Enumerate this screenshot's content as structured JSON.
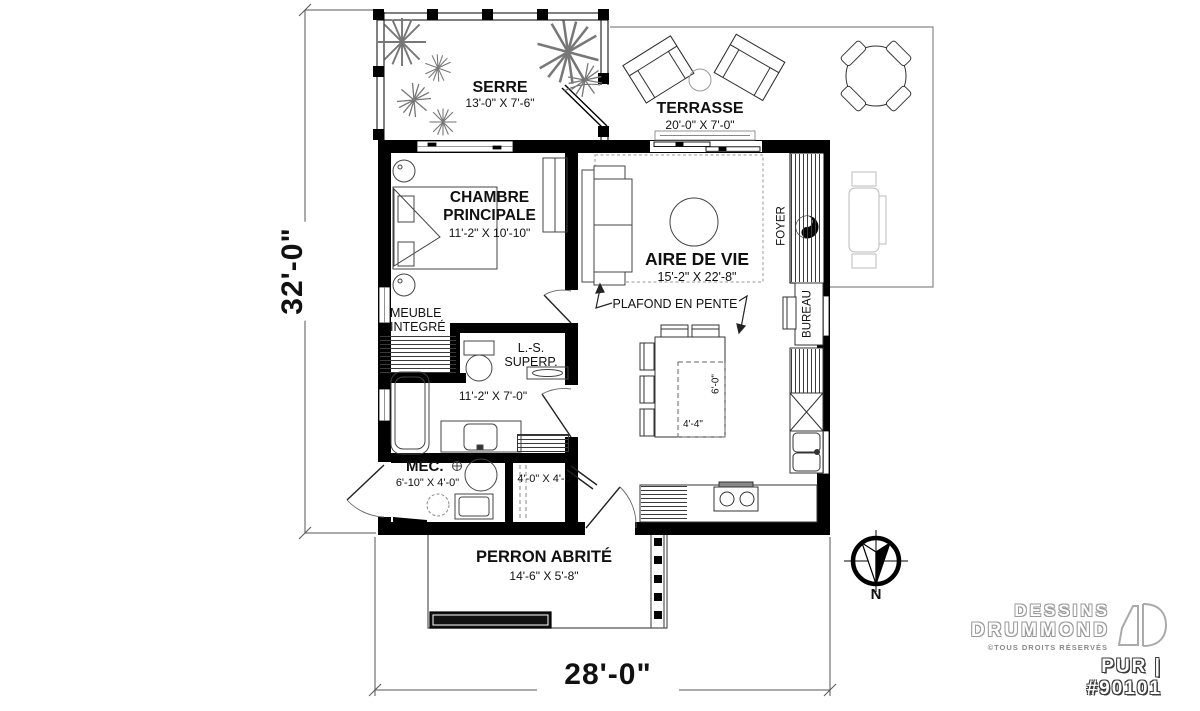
{
  "rooms": {
    "serre": {
      "name": "SERRE",
      "dims": "13'-0\" X 7'-6\""
    },
    "terrasse": {
      "name": "TERRASSE",
      "dims": "20'-0\" X 7'-0\""
    },
    "chambre": {
      "name": "CHAMBRE PRINCIPALE",
      "dims": "11'-2\" X 10'-10\""
    },
    "aire_de_vie": {
      "name": "AIRE DE VIE",
      "dims": "15'-2\" X 22'-8\""
    },
    "salle_de_bain": {
      "dims": "11'-2\" X 7'-0\""
    },
    "mec": {
      "name": "MÉC.",
      "dims": "6'-10\" X 4'-0\""
    },
    "rangement": {
      "dims": "4'-0\" X 4'-0\""
    },
    "perron": {
      "name": "PERRON ABRITÉ",
      "dims": "14'-6\" X 5'-8\""
    }
  },
  "annotations": {
    "meuble_integre": "MEUBLE INTEGRÉ",
    "ls_superp": "L.-S. SUPERP.",
    "plafond_en_pente": "PLAFOND EN PENTE",
    "foyer": "FOYER",
    "bureau": "BUREAU",
    "table_width": "4'-4\"",
    "table_depth": "6'-0\"",
    "north": "N"
  },
  "overall_dimensions": {
    "height": "32'-0\"",
    "width": "28'-0\""
  },
  "branding": {
    "company_line1": "DESSINS",
    "company_line2": "DRUMMOND",
    "rights": "©TOUS DROITS RÉSERVÉS",
    "model": "PUR | #90101"
  },
  "colors": {
    "wall": "#000000",
    "furniture_line": "#444444",
    "light_line": "#999999",
    "background": "#ffffff"
  }
}
